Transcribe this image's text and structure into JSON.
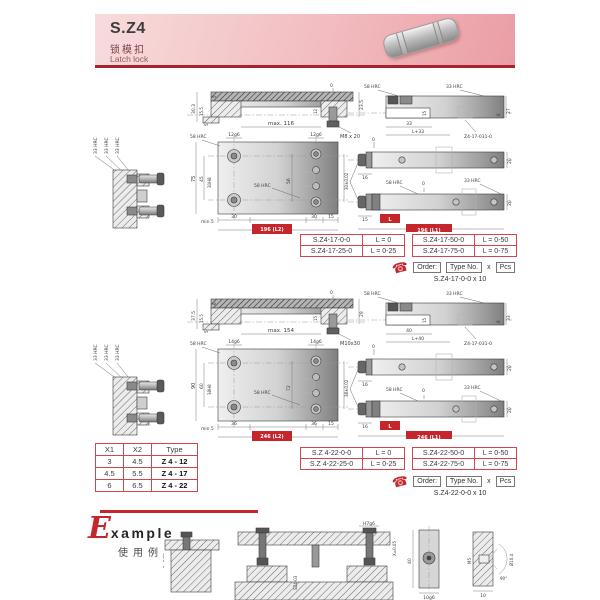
{
  "colors": {
    "accent_red": "#c5262c",
    "table_border": "#cf4850",
    "header_pink": "#f2bcc0"
  },
  "icons": {
    "phone": "☎"
  },
  "header": {
    "model": "S.Z4",
    "name_cn": "锁模扣",
    "name_en": "Latch lock"
  },
  "g1": {
    "side_labels": [
      "33 HRC",
      "33 HRC",
      "33 HRC"
    ],
    "section": {
      "zero": "0",
      "outer": "30.3",
      "mid": "15.5",
      "small": "5",
      "flange": "5",
      "right": "23.5",
      "screw": "12",
      "max_len": "max. 116",
      "thread": "M8 x 20"
    },
    "plan": {
      "hrc_top": "58 HRC",
      "hrc_mid": "58 HRC",
      "pin_l": "12g6",
      "pin_r": "12g6",
      "oh": "75",
      "ih": "45",
      "bore": "30H8",
      "mid": "56",
      "right": "30±0.02",
      "min": "min.5",
      "w1": "30",
      "w2": "30",
      "w3": "15",
      "total": "196 (L2)"
    },
    "holder": {
      "hrc58": "58 HRC",
      "hrc33": "33 HRC",
      "w": "33",
      "wl": "L+33",
      "h1": "6",
      "h2": "27",
      "inner": "15",
      "part": "Z4-17-031-0"
    },
    "bar_top": {
      "zero": "0",
      "neck": "16",
      "h": "20"
    },
    "bar_bot": {
      "hrc58": "58 HRC",
      "zero": "0",
      "hrc33": "33 HRC",
      "off": "15",
      "len": "L",
      "total": "196 (L1)",
      "h": "20"
    },
    "table": [
      {
        "no": "S.Z4-17-0-0",
        "len": "L = 0"
      },
      {
        "no": "S.Z4-17-25-0",
        "len": "L = 0-25"
      },
      {
        "no": "S.Z4-17-50-0",
        "len": "L = 0-50"
      },
      {
        "no": "S.Z4-17-75-0",
        "len": "L = 0-75"
      }
    ],
    "order": {
      "order": "Order:",
      "type": "Type No.",
      "times": "x",
      "pcs": "Pcs",
      "sample": "S.Z4-17-0-0 x 10"
    }
  },
  "g2": {
    "side_labels": [
      "33 HRC",
      "33 HRC",
      "33 HRC"
    ],
    "section": {
      "zero": "0",
      "outer": "37.5",
      "mid": "15.5",
      "small": "5",
      "flange": "6",
      "right": "29",
      "screw": "15",
      "max_len": "max. 154",
      "thread": "M10x30"
    },
    "plan": {
      "hrc_top": "58 HRC",
      "hrc_mid": "58 HRC",
      "pin_l": "14g6",
      "pin_r": "14g6",
      "oh": "90",
      "ih": "60",
      "bore": "38H8",
      "mid": "72",
      "right": "38±0.02",
      "min": "min.5",
      "w1": "36",
      "w2": "36",
      "w3": "15",
      "total": "246 (L2)"
    },
    "holder": {
      "hrc58": "58 HRC",
      "hrc33": "33 HRC",
      "w": "40",
      "wl": "L+40",
      "h1": "8",
      "h2": "33",
      "inner": "15",
      "part": "Z4-17-031-0"
    },
    "bar_top": {
      "zero": "0",
      "neck": "16",
      "h": "20"
    },
    "bar_bot": {
      "hrc58": "58 HRC",
      "zero": "0",
      "hrc33": "33 HRC",
      "off": "16",
      "len": "L",
      "total": "246 (L1)",
      "h": "20"
    },
    "table": [
      {
        "no": "S.Z 4-22-0-0",
        "len": "L = 0"
      },
      {
        "no": "S.Z 4-22-25-0",
        "len": "L = 0-25"
      },
      {
        "no": "S.Z4-22-50-0",
        "len": "L = 0-50"
      },
      {
        "no": "S.Z4-22-75-0",
        "len": "L = 0-75"
      }
    ],
    "order": {
      "order": "Order:",
      "type": "Type No.",
      "times": "x",
      "pcs": "Pcs",
      "sample": "S.Z4-22-0-0 x 10"
    }
  },
  "xtable": {
    "headers": [
      "X1",
      "X2",
      "Type"
    ],
    "rows": [
      [
        "3",
        "4.5",
        "Z 4 - 12"
      ],
      [
        "4.5",
        "5.5",
        "Z 4 - 17"
      ],
      [
        "6",
        "6.5",
        "Z 4 - 22"
      ]
    ]
  },
  "example": {
    "initial": "E",
    "rest": "xample",
    "cn": "使用例",
    "dims": {
      "flat": "0~0.05",
      "fit": "H7g6",
      "x": "X=0.05",
      "part": "SZ4-03",
      "h40": "40",
      "g6": "10g6",
      "m5": "M5",
      "dia": "Ø10.4",
      "ang": "90°",
      "w10": "10"
    }
  }
}
